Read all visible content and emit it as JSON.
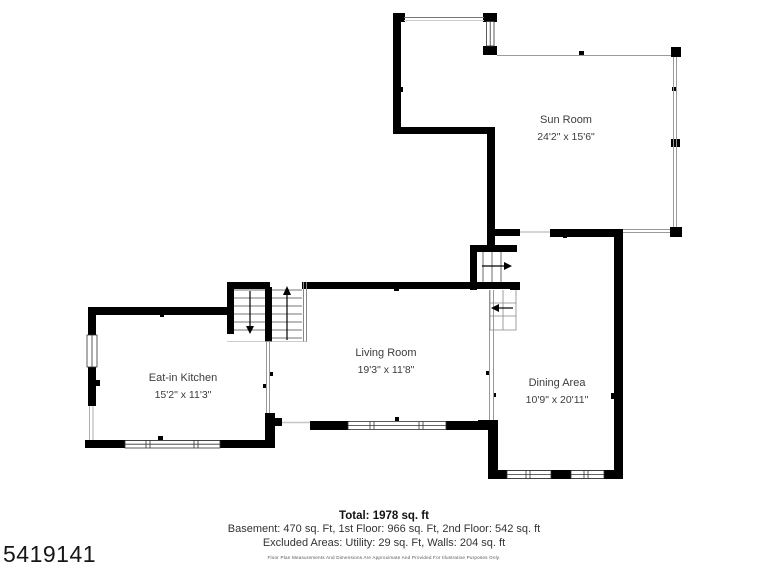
{
  "plan": {
    "listing_id": "5419141",
    "rooms": [
      {
        "name": "Sun Room",
        "dimensions": "24'2\" x 15'6\""
      },
      {
        "name": "Eat-in Kitchen",
        "dimensions": "15'2\" x 11'3\""
      },
      {
        "name": "Living Room",
        "dimensions": "19'3\" x 11'8\""
      },
      {
        "name": "Dining Area",
        "dimensions": "10'9\" x 20'11\""
      }
    ],
    "summary": {
      "total": "Total: 1978 sq. ft",
      "floors": "Basement: 470 sq. Ft, 1st Floor: 966 sq. Ft, 2nd Floor: 542 sq. ft",
      "excluded": "Excluded Areas: Utility: 29 sq. Ft, Walls: 204 sq. ft",
      "disclaimer": "Floor Plan Measurements And Dimensions Are Approximate And Provided For Illustrative Purposes Only."
    },
    "colors": {
      "wall": "#000000",
      "thin_line": "#9a9a9a",
      "label_text": "#3c3c3c"
    }
  }
}
